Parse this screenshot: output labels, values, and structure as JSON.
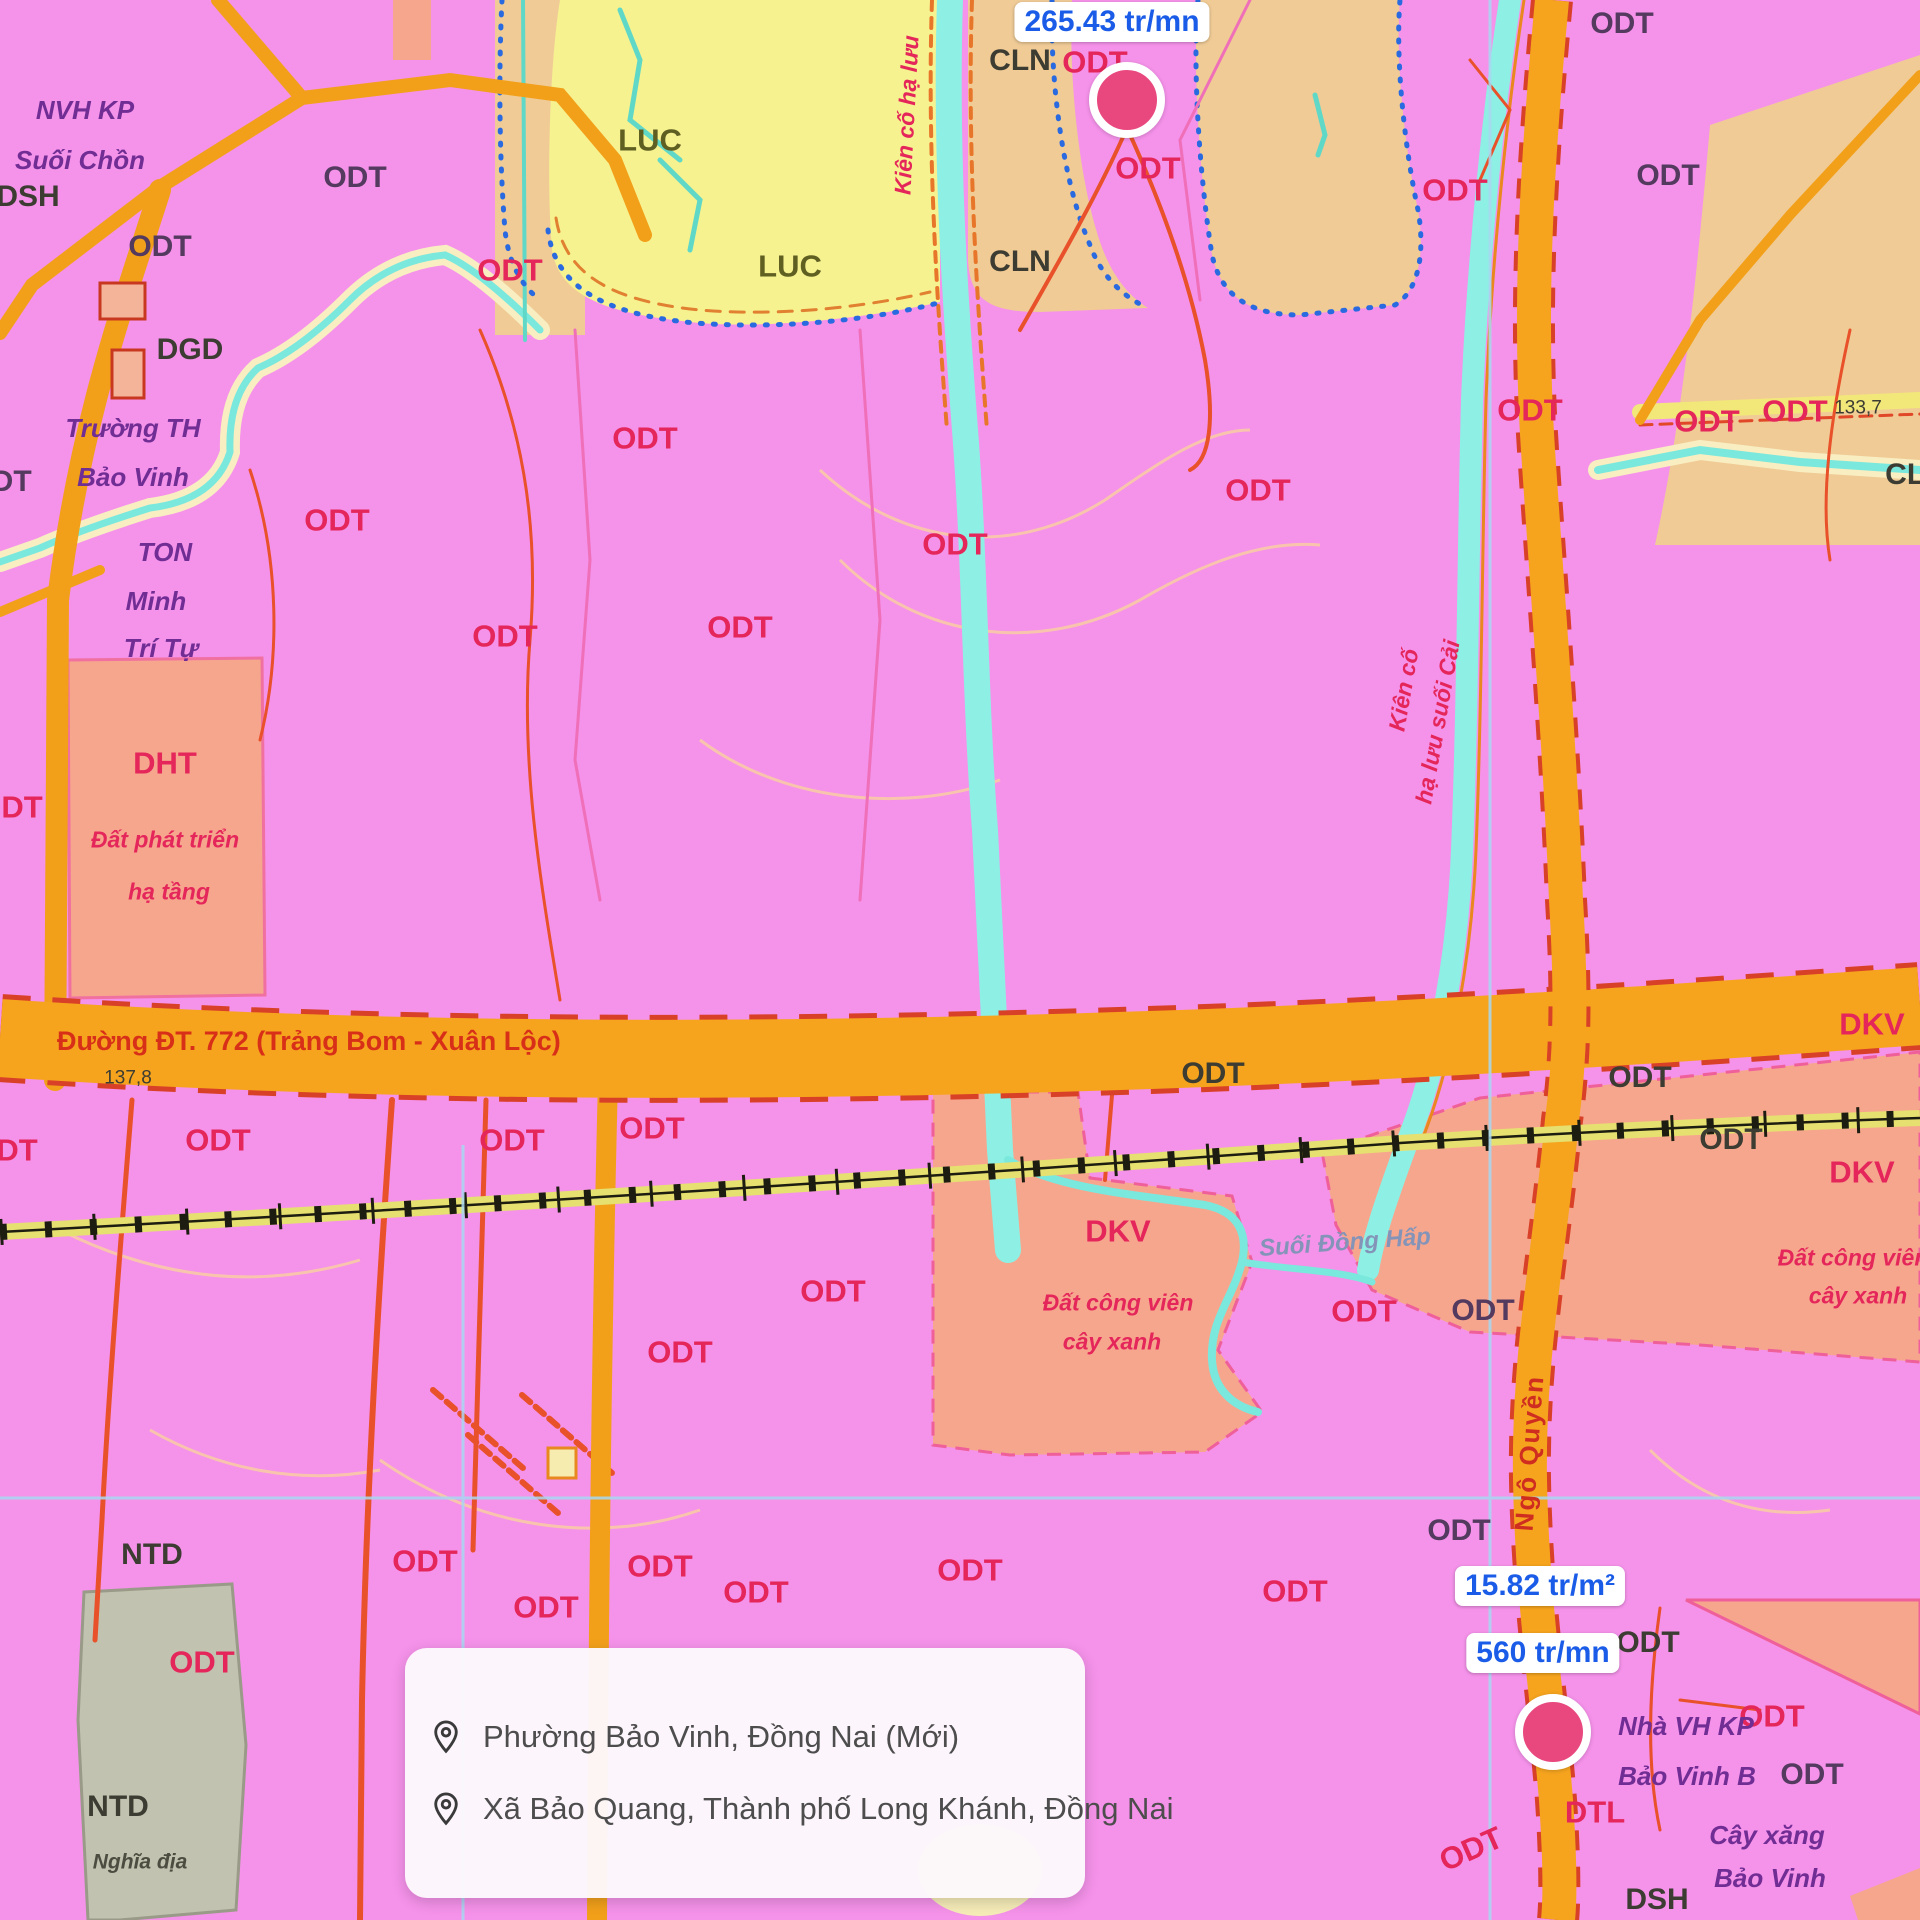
{
  "map": {
    "labels": [
      {
        "text": "ODT",
        "x": 355,
        "y": 178,
        "t": "p"
      },
      {
        "text": "ODT",
        "x": 160,
        "y": 247,
        "t": "p"
      },
      {
        "text": "ODT",
        "x": 0,
        "y": 482,
        "t": "p"
      },
      {
        "text": "DSH",
        "x": 28,
        "y": 197,
        "t": "d"
      },
      {
        "text": "DGD",
        "x": 190,
        "y": 350,
        "t": "d"
      },
      {
        "text": "NVH KP",
        "x": 85,
        "y": 110,
        "t": "pu"
      },
      {
        "text": "Suối Chồn",
        "x": 80,
        "y": 160,
        "t": "pu"
      },
      {
        "text": "Trường TH",
        "x": 133,
        "y": 428,
        "t": "pu"
      },
      {
        "text": "Bảo Vinh",
        "x": 133,
        "y": 477,
        "t": "pu"
      },
      {
        "text": "TON",
        "x": 165,
        "y": 552,
        "t": "pu"
      },
      {
        "text": "Minh",
        "x": 156,
        "y": 601,
        "t": "pu"
      },
      {
        "text": "Trí Tự",
        "x": 161,
        "y": 648,
        "t": "pu"
      },
      {
        "text": "LUC",
        "x": 650,
        "y": 140,
        "t": "l"
      },
      {
        "text": "LUC",
        "x": 790,
        "y": 266,
        "t": "l"
      },
      {
        "text": "CLN",
        "x": 1020,
        "y": 61,
        "t": "d"
      },
      {
        "text": "CLN",
        "x": 1020,
        "y": 262,
        "t": "d"
      },
      {
        "text": "ODT",
        "x": 510,
        "y": 270,
        "t": "r"
      },
      {
        "text": "ODT",
        "x": 645,
        "y": 438,
        "t": "r"
      },
      {
        "text": "ODT",
        "x": 337,
        "y": 520,
        "t": "r"
      },
      {
        "text": "ODT",
        "x": 505,
        "y": 636,
        "t": "r"
      },
      {
        "text": "ODT",
        "x": 740,
        "y": 627,
        "t": "r"
      },
      {
        "text": "ODT",
        "x": 955,
        "y": 544,
        "t": "r"
      },
      {
        "text": "ODT",
        "x": 1095,
        "y": 62,
        "t": "r"
      },
      {
        "text": "ODT",
        "x": 1148,
        "y": 168,
        "t": "r"
      },
      {
        "text": "ODT",
        "x": 1455,
        "y": 190,
        "t": "r"
      },
      {
        "text": "ODT",
        "x": 1258,
        "y": 490,
        "t": "r"
      },
      {
        "text": "ODT",
        "x": 1530,
        "y": 410,
        "t": "r"
      },
      {
        "text": "ODT",
        "x": 1707,
        "y": 421,
        "t": "r"
      },
      {
        "text": "ODT",
        "x": 1795,
        "y": 411,
        "t": "r"
      },
      {
        "text": "ODT",
        "x": 1622,
        "y": 24,
        "t": "p"
      },
      {
        "text": "ODT",
        "x": 1668,
        "y": 176,
        "t": "p"
      },
      {
        "text": "CLN",
        "x": 1916,
        "y": 475,
        "t": "d"
      },
      {
        "text": "133,7",
        "x": 1858,
        "y": 408,
        "t": "s"
      },
      {
        "text": "Kiên cố hạ lưu",
        "x": 907,
        "y": 115,
        "t": "ri",
        "rot": -87
      },
      {
        "text": "Kiên cố",
        "x": 1404,
        "y": 690,
        "t": "ri",
        "rot": -80
      },
      {
        "text": "hạ lưu suối Cải",
        "x": 1438,
        "y": 722,
        "t": "ri",
        "rot": -80
      },
      {
        "text": "ODT",
        "x": 10,
        "y": 807,
        "t": "r"
      },
      {
        "text": "DHT",
        "x": 165,
        "y": 763,
        "t": "r"
      },
      {
        "text": "Đất phát triển",
        "x": 165,
        "y": 840,
        "t": "ri"
      },
      {
        "text": "hạ tầng",
        "x": 169,
        "y": 892,
        "t": "ri"
      },
      {
        "text": "137,8",
        "x": 128,
        "y": 1078,
        "t": "s"
      },
      {
        "text": "ODT",
        "x": 5,
        "y": 1150,
        "t": "r"
      },
      {
        "text": "ODT",
        "x": 218,
        "y": 1140,
        "t": "r"
      },
      {
        "text": "ODT",
        "x": 512,
        "y": 1140,
        "t": "r"
      },
      {
        "text": "ODT",
        "x": 652,
        "y": 1128,
        "t": "r"
      },
      {
        "text": "ODT",
        "x": 1213,
        "y": 1074,
        "t": "d"
      },
      {
        "text": "ODT",
        "x": 1640,
        "y": 1078,
        "t": "d"
      },
      {
        "text": "ODT",
        "x": 1731,
        "y": 1140,
        "t": "d"
      },
      {
        "text": "ODT",
        "x": 680,
        "y": 1352,
        "t": "r"
      },
      {
        "text": "ODT",
        "x": 833,
        "y": 1291,
        "t": "r"
      },
      {
        "text": "DKV",
        "x": 1118,
        "y": 1231,
        "t": "r"
      },
      {
        "text": "Đất công viên",
        "x": 1118,
        "y": 1303,
        "t": "ri"
      },
      {
        "text": "cây xanh",
        "x": 1112,
        "y": 1342,
        "t": "ri"
      },
      {
        "text": "Suối Đồng Hấp",
        "x": 1345,
        "y": 1243,
        "t": "w",
        "rot": -4
      },
      {
        "text": "DKV",
        "x": 1872,
        "y": 1024,
        "t": "r"
      },
      {
        "text": "DKV",
        "x": 1862,
        "y": 1172,
        "t": "r"
      },
      {
        "text": "Đất công viên",
        "x": 1853,
        "y": 1258,
        "t": "ri"
      },
      {
        "text": "cây xanh",
        "x": 1858,
        "y": 1296,
        "t": "ri"
      },
      {
        "text": "ODT",
        "x": 1364,
        "y": 1311,
        "t": "r"
      },
      {
        "text": "ODT",
        "x": 1483,
        "y": 1311,
        "t": "p"
      },
      {
        "text": "ODT",
        "x": 1459,
        "y": 1531,
        "t": "p"
      },
      {
        "text": "ODT",
        "x": 1295,
        "y": 1591,
        "t": "r"
      },
      {
        "text": "Ngô Quyền",
        "x": 1529,
        "y": 1453,
        "t": "st",
        "rot": -86
      },
      {
        "text": "NTD",
        "x": 152,
        "y": 1555,
        "t": "d"
      },
      {
        "text": "ODT",
        "x": 202,
        "y": 1662,
        "t": "r"
      },
      {
        "text": "NTD",
        "x": 118,
        "y": 1807,
        "t": "d"
      },
      {
        "text": "Nghĩa địa",
        "x": 140,
        "y": 1862,
        "t": "di"
      },
      {
        "text": "ODT",
        "x": 425,
        "y": 1561,
        "t": "r"
      },
      {
        "text": "ODT",
        "x": 546,
        "y": 1607,
        "t": "r"
      },
      {
        "text": "ODT",
        "x": 660,
        "y": 1566,
        "t": "r"
      },
      {
        "text": "ODT",
        "x": 756,
        "y": 1592,
        "t": "r"
      },
      {
        "text": "ODT",
        "x": 970,
        "y": 1570,
        "t": "r"
      },
      {
        "text": "ODT",
        "x": 1648,
        "y": 1643,
        "t": "d"
      },
      {
        "text": "ODT",
        "x": 1772,
        "y": 1716,
        "t": "r"
      },
      {
        "text": "ODT",
        "x": 1812,
        "y": 1775,
        "t": "p"
      },
      {
        "text": "Nhà VH KP",
        "x": 1686,
        "y": 1726,
        "t": "pu"
      },
      {
        "text": "Bảo Vinh B",
        "x": 1687,
        "y": 1776,
        "t": "pu"
      },
      {
        "text": "DTL",
        "x": 1595,
        "y": 1812,
        "t": "r"
      },
      {
        "text": "ODT",
        "x": 1471,
        "y": 1849,
        "t": "r",
        "rot": -24
      },
      {
        "text": "Cây xăng",
        "x": 1767,
        "y": 1835,
        "t": "pu"
      },
      {
        "text": "Bảo Vinh",
        "x": 1770,
        "y": 1878,
        "t": "pu"
      },
      {
        "text": "DSH",
        "x": 1657,
        "y": 1900,
        "t": "d"
      }
    ],
    "road_label": "Đường ĐT. 772 (Trảng Bom - Xuân Lộc)",
    "price_markers": [
      {
        "label": "265.43 tr/mn",
        "pill_x": 1112,
        "pill_y": 22,
        "dot_x": 1127,
        "dot_y": 100
      },
      {
        "label": "15.82 tr/m²",
        "pill_x": 1540,
        "pill_y": 1586
      },
      {
        "label": "560 tr/mn",
        "pill_x": 1543,
        "pill_y": 1653,
        "dot_x": 1553,
        "dot_y": 1732
      }
    ]
  },
  "location_card": {
    "items": [
      {
        "label": "Phường Bảo Vinh, Đồng Nai (Mới)"
      },
      {
        "label": "Xã Bảo Quang, Thành phố Long Khánh, Đồng Nai"
      }
    ]
  },
  "palette": {
    "zone_odt_pink": "#f592ea",
    "zone_luc_yellow": "#f6f290",
    "zone_cln_tan": "#f0cb96",
    "zone_dkv_salmon": "#f7a68e",
    "zone_ntd_gray": "#c2c2b0",
    "road_orange": "#f6a41e",
    "road_edge_red": "#d84028",
    "railway_khaki": "#e6e070",
    "water_cyan": "#8ef0e4",
    "stream_bank_cream": "#f8eec2",
    "grid_blue": "#a8d8f2",
    "label_red": "#e4265a",
    "price_blue": "#1a5ce8",
    "marker_pink": "#e8487e"
  }
}
